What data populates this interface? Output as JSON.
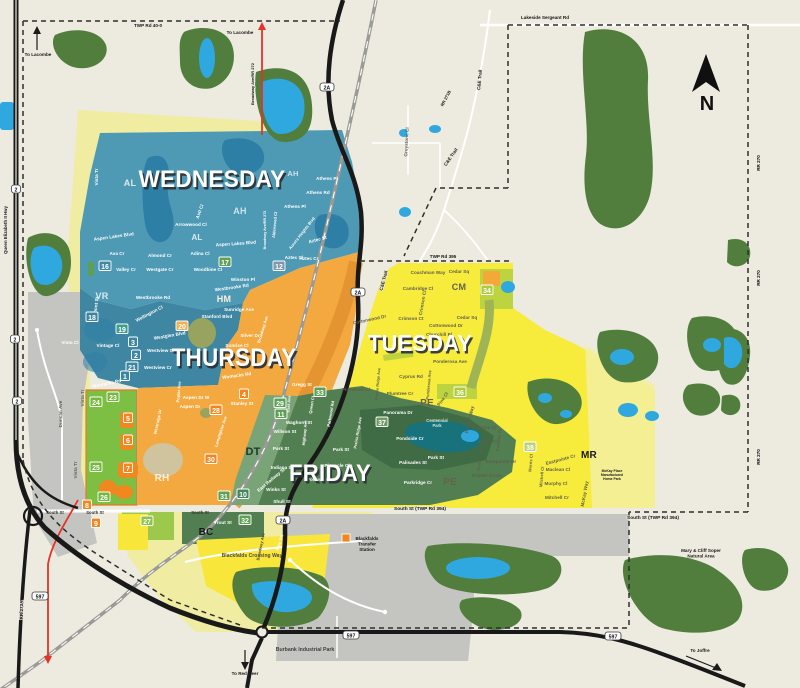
{
  "map": {
    "compass_label": "N",
    "colors": {
      "background": "#EDEADF",
      "forest": "#517D3D",
      "water": "#2FA8E0",
      "lake": "#2E7FA5",
      "gray": "#C4C4C0",
      "pale_yellow": "#F0EDA2",
      "bright_green": "#7CBF42",
      "lime": "#BCD43F",
      "pale_mr": "#F2F0A2",
      "dt_green": "#79A477",
      "park_green": "#3F6B45",
      "park_teal": "#17727B",
      "corridor_orange": "#E0922F",
      "road_red": "#E63227",
      "station_orange": "#F0871F",
      "bc_yellow": "#F9E63A",
      "band_green": "#527F51",
      "light_green_27": "#9CC84B",
      "olive": "#97A35F",
      "tan": "#CFC49D",
      "vr_teal": "#3E86A2",
      "cm_orange_patch": "#F2A938"
    },
    "day_zones": [
      {
        "label": "WEDNESDAY",
        "color": "#4E9AB5",
        "x": 212,
        "y": 187,
        "s": 24,
        "tl": 147
      },
      {
        "label": "THURSDAY",
        "color": "#F3A93F",
        "x": 234,
        "y": 366,
        "s": 25,
        "tl": 125
      },
      {
        "label": "TUESDAY",
        "color": "#F7EB3B",
        "x": 420,
        "y": 351,
        "s": 23,
        "tl": 104
      },
      {
        "label": "FRIDAY",
        "color": "#527F51",
        "x": 330,
        "y": 481,
        "s": 24,
        "tl": 82
      }
    ],
    "area_codes": [
      {
        "code": "AL",
        "x": 130,
        "y": 186,
        "s": 9,
        "c": "#D7EBF2"
      },
      {
        "code": "AL",
        "x": 197,
        "y": 240,
        "s": 8,
        "c": "#D7EBF2"
      },
      {
        "code": "AH",
        "x": 293,
        "y": 176,
        "s": 7.5,
        "c": "#CBE2EC"
      },
      {
        "code": "AH",
        "x": 240,
        "y": 214,
        "s": 9,
        "c": "#CBE2EC"
      },
      {
        "code": "VR",
        "x": 102,
        "y": 299,
        "s": 9,
        "c": "#D7EBF2"
      },
      {
        "code": "HM",
        "x": 224,
        "y": 302,
        "s": 9,
        "c": "#FBEFD8"
      },
      {
        "code": "RH",
        "x": 162,
        "y": 481,
        "s": 10,
        "c": "#FBEFD8"
      },
      {
        "code": "CM",
        "x": 459,
        "y": 290,
        "s": 9,
        "c": "#64644E"
      },
      {
        "code": "PE",
        "x": 427,
        "y": 406,
        "s": 10,
        "c": "#64644E"
      },
      {
        "code": "PE",
        "x": 450,
        "y": 485,
        "s": 10,
        "c": "#64644E"
      },
      {
        "code": "DT",
        "x": 253,
        "y": 455,
        "s": 11,
        "c": "#22382A"
      },
      {
        "code": "MR",
        "x": 589,
        "y": 458,
        "s": 10,
        "c": "#1A1A1A"
      },
      {
        "code": "BC",
        "x": 206,
        "y": 535,
        "s": 10,
        "c": "#1A1A1A"
      }
    ],
    "badges": [
      {
        "n": "16",
        "x": 105,
        "y": 268,
        "f": "#3F89A6"
      },
      {
        "n": "17",
        "x": 225,
        "y": 264,
        "f": "#5EA054"
      },
      {
        "n": "12",
        "x": 279,
        "y": 268,
        "f": "#7E98AC"
      },
      {
        "n": "18",
        "x": 92,
        "y": 319,
        "f": "#3D86A3"
      },
      {
        "n": "19",
        "x": 122,
        "y": 331,
        "f": "#3F9D8A"
      },
      {
        "n": "20",
        "x": 182,
        "y": 328,
        "f": "#F0B054"
      },
      {
        "n": "2",
        "x": 136,
        "y": 357,
        "f": "#3D86A3"
      },
      {
        "n": "3",
        "x": 133,
        "y": 344,
        "f": "#3D86A3"
      },
      {
        "n": "21",
        "x": 132,
        "y": 369,
        "f": "#3D86A3"
      },
      {
        "n": "1",
        "x": 125,
        "y": 378,
        "f": "#3D86A3"
      },
      {
        "n": "24",
        "x": 96,
        "y": 404,
        "f": "#74B83E"
      },
      {
        "n": "23",
        "x": 113,
        "y": 399,
        "f": "#74B83E"
      },
      {
        "n": "5",
        "x": 128,
        "y": 420,
        "f": "#F0871F"
      },
      {
        "n": "6",
        "x": 128,
        "y": 442,
        "f": "#F0871F"
      },
      {
        "n": "25",
        "x": 96,
        "y": 469,
        "f": "#74B83E"
      },
      {
        "n": "7",
        "x": 128,
        "y": 470,
        "f": "#F0871F"
      },
      {
        "n": "26",
        "x": 104,
        "y": 499,
        "f": "#74B83E"
      },
      {
        "n": "8",
        "x": 87,
        "y": 507,
        "f": "#F0871F"
      },
      {
        "n": "9",
        "x": 96,
        "y": 525,
        "f": "#F0871F"
      },
      {
        "n": "27",
        "x": 147,
        "y": 523,
        "f": "#8FC24C"
      },
      {
        "n": "28",
        "x": 216,
        "y": 412,
        "f": "#F0871F"
      },
      {
        "n": "4",
        "x": 244,
        "y": 396,
        "f": "#F0871F"
      },
      {
        "n": "29",
        "x": 280,
        "y": 405,
        "f": "#5EA054"
      },
      {
        "n": "11",
        "x": 281,
        "y": 416,
        "f": "#5EA054"
      },
      {
        "n": "30",
        "x": 211,
        "y": 461,
        "f": "#F0871F"
      },
      {
        "n": "31",
        "x": 224,
        "y": 498,
        "f": "#5EA054"
      },
      {
        "n": "10",
        "x": 243,
        "y": 496,
        "f": "#47855C"
      },
      {
        "n": "32",
        "x": 245,
        "y": 522,
        "f": "#5EA054"
      },
      {
        "n": "33",
        "x": 320,
        "y": 394,
        "f": "#5EA054"
      },
      {
        "n": "37",
        "x": 382,
        "y": 424,
        "f": "#6F9C62"
      },
      {
        "n": "36",
        "x": 460,
        "y": 394,
        "f": "#AECB3E"
      },
      {
        "n": "34",
        "x": 487,
        "y": 292,
        "f": "#AECB3E"
      },
      {
        "n": "38",
        "x": 530,
        "y": 449,
        "f": "#BCCF7A"
      }
    ],
    "road_labels": [
      {
        "t": "TWP Rd 40-0",
        "x": 148,
        "y": 27
      },
      {
        "t": "Lakeside Sergeant Rd",
        "x": 545,
        "y": 19
      },
      {
        "t": "TWP Rd 395",
        "x": 443,
        "y": 258
      },
      {
        "t": "South St (TWP Rd 394)",
        "x": 420,
        "y": 510,
        "s": 4.8
      },
      {
        "t": "South St (TWP Rd 394)",
        "x": 653,
        "y": 519,
        "s": 4.8
      },
      {
        "t": "RR 270",
        "x": 760,
        "y": 163,
        "r": -90
      },
      {
        "t": "RR 270",
        "x": 760,
        "y": 278,
        "r": -90
      },
      {
        "t": "RR 270",
        "x": 760,
        "y": 457,
        "r": -90
      },
      {
        "t": "Queen Elizabeth II Hwy",
        "x": 7,
        "y": 230,
        "r": -90,
        "s": 4.4
      },
      {
        "t": "RR 273A",
        "x": 23,
        "y": 610,
        "r": -90
      },
      {
        "t": "RR 271B",
        "x": 447,
        "y": 99,
        "r": -62,
        "s": 4.2
      },
      {
        "t": "C&E Trail",
        "x": 481,
        "y": 80,
        "r": -85
      },
      {
        "t": "C&E Trail",
        "x": 452,
        "y": 158,
        "r": -55
      },
      {
        "t": "C&E Trail",
        "x": 385,
        "y": 281,
        "r": -75
      },
      {
        "t": "Broadway Ave/RR 272",
        "x": 254,
        "y": 84,
        "r": -90,
        "s": 4
      }
    ],
    "shields": [
      {
        "t": "2A",
        "x": 327,
        "y": 88
      },
      {
        "t": "2A",
        "x": 358,
        "y": 293
      },
      {
        "t": "2A",
        "x": 283,
        "y": 521
      },
      {
        "t": "597",
        "x": 40,
        "y": 597
      },
      {
        "t": "597",
        "x": 351,
        "y": 636
      },
      {
        "t": "597",
        "x": 613,
        "y": 637
      },
      {
        "t": "2",
        "x": 16,
        "y": 190
      },
      {
        "t": "2",
        "x": 15,
        "y": 340
      },
      {
        "t": "2",
        "x": 17,
        "y": 402
      }
    ],
    "directions": [
      {
        "t": "To Lacombe",
        "x": 38,
        "y": 56
      },
      {
        "t": "To Lacombe",
        "x": 240,
        "y": 34
      },
      {
        "t": "To Red Deer",
        "x": 245,
        "y": 675
      },
      {
        "t": "To Joffre",
        "x": 700,
        "y": 652
      }
    ],
    "pois": [
      {
        "lines": [
          "Centennial",
          "Park"
        ],
        "x": 437,
        "y": 422,
        "s": 4.2,
        "c": "#D6E8DC"
      },
      {
        "lines": [
          "Blackfalds",
          "Transfer",
          "Station"
        ],
        "x": 367,
        "y": 540,
        "s": 4.6
      },
      {
        "t": "Burbank Industrial Park",
        "x": 305,
        "y": 651,
        "s": 5.2,
        "c": "#3F3F3F"
      },
      {
        "lines": [
          "Mary & Cliff Soper",
          "Natural Area"
        ],
        "x": 701,
        "y": 552,
        "s": 4.6
      },
      {
        "lines": [
          "McKay Place",
          "Manufactured",
          "Home Park"
        ],
        "x": 612,
        "y": 472,
        "s": 3.4
      }
    ],
    "streets": [
      {
        "t": "Vista Tr",
        "x": 98,
        "y": 177,
        "r": -90
      },
      {
        "t": "Vista Tr",
        "x": 84,
        "y": 398,
        "r": -90,
        "c": "#5F5F50"
      },
      {
        "t": "Vista Tr",
        "x": 77,
        "y": 470,
        "r": -90,
        "c": "#5F5F50"
      },
      {
        "t": "Aspen Lakes Blvd",
        "x": 114,
        "y": 238,
        "r": -8
      },
      {
        "t": "Aspen Lakes Blvd",
        "x": 236,
        "y": 245,
        "r": -4
      },
      {
        "t": "Ava Cr",
        "x": 117,
        "y": 255
      },
      {
        "t": "Valley Cr",
        "x": 126,
        "y": 271
      },
      {
        "t": "Almond Cr",
        "x": 160,
        "y": 257
      },
      {
        "t": "Westgate Cr",
        "x": 160,
        "y": 271
      },
      {
        "t": "Adina Cl",
        "x": 200,
        "y": 255
      },
      {
        "t": "Woodbine Cl",
        "x": 208,
        "y": 271
      },
      {
        "t": "Winston Pl",
        "x": 243,
        "y": 281
      },
      {
        "t": "Arrowwood Cl",
        "x": 191,
        "y": 226
      },
      {
        "t": "Asti Cl",
        "x": 201,
        "y": 212,
        "r": -70
      },
      {
        "t": "Athens Pl",
        "x": 327,
        "y": 180
      },
      {
        "t": "Athens Rd",
        "x": 318,
        "y": 194
      },
      {
        "t": "Athens Pl",
        "x": 295,
        "y": 208
      },
      {
        "t": "Aurora Heights Blvd",
        "x": 303,
        "y": 234,
        "r": -52,
        "s": 4
      },
      {
        "t": "Aztec St",
        "x": 318,
        "y": 241,
        "r": -15
      },
      {
        "t": "Aztec Cr",
        "x": 309,
        "y": 260
      },
      {
        "t": "Aztec Cl",
        "x": 294,
        "y": 259
      },
      {
        "t": "Alderwood Cl",
        "x": 276,
        "y": 225,
        "r": -85,
        "s": 4
      },
      {
        "t": "Broadway Ave/RR 272",
        "x": 266,
        "y": 230,
        "r": -90,
        "s": 3.6
      },
      {
        "t": "Westbrooke Rd",
        "x": 232,
        "y": 289,
        "r": -8
      },
      {
        "t": "Westbrooke Rd",
        "x": 153,
        "y": 299
      },
      {
        "t": "Valmont St",
        "x": 97,
        "y": 309,
        "r": -82
      },
      {
        "t": "Vintage Cl",
        "x": 108,
        "y": 347
      },
      {
        "t": "Vista Cl",
        "x": 70,
        "y": 344
      },
      {
        "t": "Womacks Rd",
        "x": 107,
        "y": 385,
        "r": -12
      },
      {
        "t": "Sunridge Ave",
        "x": 239,
        "y": 311
      },
      {
        "t": "Stanford Blvd",
        "x": 217,
        "y": 318
      },
      {
        "t": "Silver Dr",
        "x": 250,
        "y": 337
      },
      {
        "t": "Sunrise Cl",
        "x": 237,
        "y": 347
      },
      {
        "t": "Wellington Cl",
        "x": 150,
        "y": 315,
        "r": -28
      },
      {
        "t": "Westglen Blvd",
        "x": 170,
        "y": 337,
        "r": -10
      },
      {
        "t": "Westview Cr",
        "x": 161,
        "y": 352
      },
      {
        "t": "Westview Cr",
        "x": 158,
        "y": 369
      },
      {
        "t": "Womacks Rd",
        "x": 237,
        "y": 377,
        "r": -8
      },
      {
        "t": "Aspen Dr W",
        "x": 196,
        "y": 399
      },
      {
        "t": "Aspen Dr",
        "x": 190,
        "y": 408
      },
      {
        "t": "Poplar Ave",
        "x": 180,
        "y": 392,
        "r": -85,
        "s": 4
      },
      {
        "t": "Stanley St",
        "x": 242,
        "y": 405
      },
      {
        "t": "Westridge Dr",
        "x": 159,
        "y": 422,
        "r": -78,
        "s": 4
      },
      {
        "t": "Lamplighter Ave",
        "x": 222,
        "y": 432,
        "r": -72,
        "s": 4
      },
      {
        "t": "Broadway Ave",
        "x": 264,
        "y": 330,
        "r": -73,
        "s": 4
      },
      {
        "t": "Coachman Way",
        "x": 428,
        "y": 274,
        "c": "#5F5F4C"
      },
      {
        "t": "Cedar Sq",
        "x": 459,
        "y": 273,
        "c": "#5F5F4C"
      },
      {
        "t": "Cambridge Cl",
        "x": 418,
        "y": 290,
        "c": "#5F5F4C"
      },
      {
        "t": "Crimson Cl",
        "x": 424,
        "y": 303,
        "r": -80,
        "c": "#5F5F4C"
      },
      {
        "t": "Crimson Ct",
        "x": 411,
        "y": 320,
        "c": "#5F5F4C"
      },
      {
        "t": "Cottonwood Dr",
        "x": 370,
        "y": 321,
        "r": -12,
        "c": "#5F5F4C"
      },
      {
        "t": "Cottonwood Dr",
        "x": 446,
        "y": 327,
        "c": "#5F5F4C"
      },
      {
        "t": "Cedar Sq",
        "x": 467,
        "y": 319,
        "c": "#5F5F4C"
      },
      {
        "t": "Churchill Pl",
        "x": 439,
        "y": 336,
        "c": "#5F5F4C"
      },
      {
        "t": "Ponderosa Ave",
        "x": 450,
        "y": 363,
        "c": "#5F5F4C"
      },
      {
        "t": "Ponderosa Ave",
        "x": 430,
        "y": 385,
        "r": -85,
        "s": 4,
        "c": "#5F5F4C"
      },
      {
        "t": "Cyprus Rd",
        "x": 411,
        "y": 378,
        "c": "#5F5F4C"
      },
      {
        "t": "Prairie Ridge Ave",
        "x": 379,
        "y": 384,
        "r": -85,
        "s": 3.8,
        "c": "#5F5F4C"
      },
      {
        "t": "Pinewood Cl",
        "x": 356,
        "y": 391,
        "c": "#5F5F4C"
      },
      {
        "t": "Plumtree Cr",
        "x": 400,
        "y": 395,
        "c": "#5F5F4C"
      },
      {
        "t": "Pine Cl",
        "x": 444,
        "y": 400,
        "r": -55,
        "c": "#5F5F4C"
      },
      {
        "t": "Pioneer Way",
        "x": 471,
        "y": 420,
        "r": -78,
        "c": "#5F5F4C"
      },
      {
        "t": "Pinetree Cl",
        "x": 484,
        "y": 429,
        "c": "#5F5F4C"
      },
      {
        "t": "Piper Cl",
        "x": 488,
        "y": 443,
        "c": "#5F5F4C"
      },
      {
        "t": "Pioneer Ave",
        "x": 481,
        "y": 459,
        "r": -85,
        "s": 4,
        "c": "#5F5F4C"
      },
      {
        "t": "Eastpointe Dr",
        "x": 501,
        "y": 463,
        "c": "#5F5F4C"
      },
      {
        "t": "Palmer Circle",
        "x": 487,
        "y": 477,
        "c": "#5F5F4C"
      },
      {
        "t": "Parkway Dr",
        "x": 500,
        "y": 440,
        "r": -85,
        "s": 4,
        "c": "#5F5F4C"
      },
      {
        "t": "Eastpointe Cr",
        "x": 561,
        "y": 461,
        "r": -15,
        "c": "#5F5F4C"
      },
      {
        "t": "Maclean Cl",
        "x": 558,
        "y": 471,
        "c": "#5F5F4C"
      },
      {
        "t": "Murphy Cl",
        "x": 556,
        "y": 485,
        "c": "#5F5F4C"
      },
      {
        "t": "Mitchell Cr",
        "x": 557,
        "y": 499,
        "c": "#5F5F4C"
      },
      {
        "t": "Mitchell Cl",
        "x": 543,
        "y": 477,
        "r": -85,
        "s": 4,
        "c": "#5F5F4C"
      },
      {
        "t": "Morris Cl",
        "x": 532,
        "y": 463,
        "r": -85,
        "s": 4,
        "c": "#5F5F4C"
      },
      {
        "t": "McKay Way",
        "x": 586,
        "y": 494,
        "r": -80,
        "c": "#5F5F4C"
      },
      {
        "t": "Gregg St",
        "x": 302,
        "y": 386
      },
      {
        "t": "Panorama Dr",
        "x": 398,
        "y": 414
      },
      {
        "t": "Pondside Cr",
        "x": 410,
        "y": 440
      },
      {
        "t": "Park St",
        "x": 281,
        "y": 450
      },
      {
        "t": "Park St",
        "x": 341,
        "y": 451
      },
      {
        "t": "Park St",
        "x": 436,
        "y": 459
      },
      {
        "t": "Palisades St",
        "x": 413,
        "y": 464
      },
      {
        "t": "Parkridge Cr",
        "x": 418,
        "y": 484
      },
      {
        "t": "Pinnacle Cl",
        "x": 337,
        "y": 467
      },
      {
        "t": "Portway Cl",
        "x": 319,
        "y": 481
      },
      {
        "t": "Parkwood Rd",
        "x": 332,
        "y": 414,
        "r": -80,
        "s": 4
      },
      {
        "t": "Prairie Ridge Ave",
        "x": 359,
        "y": 433,
        "r": -80,
        "s": 3.8
      },
      {
        "t": "Waghorn St",
        "x": 299,
        "y": 424
      },
      {
        "t": "Willson St",
        "x": 285,
        "y": 433
      },
      {
        "t": "East Ave",
        "x": 290,
        "y": 404,
        "r": -85,
        "s": 4
      },
      {
        "t": "Queen Cl",
        "x": 313,
        "y": 405,
        "r": -80,
        "s": 4
      },
      {
        "t": "Highway Ave",
        "x": 306,
        "y": 433,
        "r": -85,
        "s": 4
      },
      {
        "t": "Indiana St",
        "x": 282,
        "y": 469
      },
      {
        "t": "Winks St",
        "x": 276,
        "y": 491
      },
      {
        "t": "Shull St",
        "x": 282,
        "y": 503
      },
      {
        "t": "East Railway St",
        "x": 272,
        "y": 481,
        "r": -40
      },
      {
        "t": "Trout St",
        "x": 223,
        "y": 524
      },
      {
        "t": "Blackfalds Crossing Way",
        "x": 252,
        "y": 557,
        "s": 5,
        "c": "#4A4A3C"
      },
      {
        "t": "Broadway Ave",
        "x": 262,
        "y": 547,
        "r": -78,
        "s": 4,
        "c": "#4A4A3C"
      },
      {
        "t": "Duncan Ave",
        "x": 62,
        "y": 414,
        "r": -90,
        "c": "#5F5F50"
      },
      {
        "t": "Hwy 2A",
        "x": 281,
        "y": 543,
        "r": -72,
        "s": 4.4
      },
      {
        "t": "Greystone Cl",
        "x": 408,
        "y": 142,
        "r": -87,
        "c": "#5F5F50"
      },
      {
        "t": "South St",
        "x": 55,
        "y": 514,
        "s": 4.2,
        "c": "#333333"
      },
      {
        "t": "South St",
        "x": 95,
        "y": 514,
        "s": 4.2,
        "c": "#333333"
      },
      {
        "t": "South St",
        "x": 200,
        "y": 514,
        "s": 4.2,
        "c": "#333333"
      }
    ]
  }
}
